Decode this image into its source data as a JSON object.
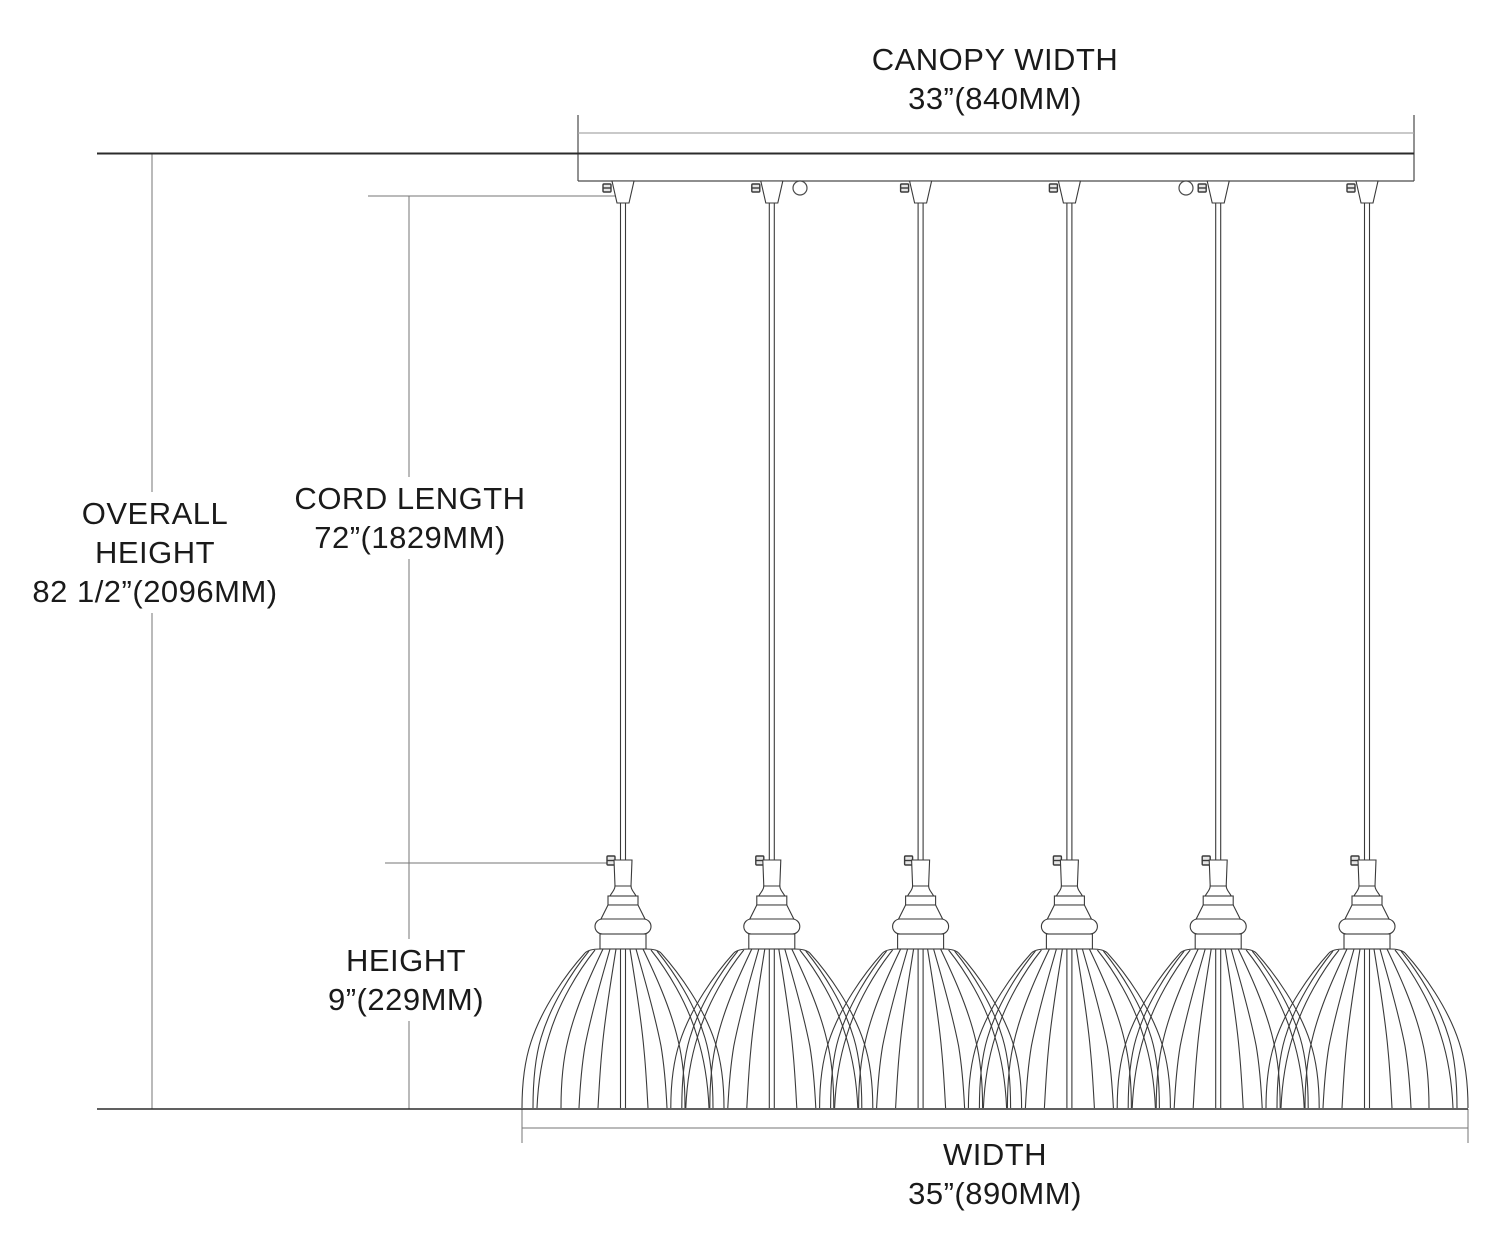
{
  "title": "Pendant fixture dimension drawing",
  "labels": {
    "canopy_width": {
      "line1": "CANOPY WIDTH",
      "line2": "33”(840MM)"
    },
    "overall_height": {
      "line1": "OVERALL",
      "line2": "HEIGHT",
      "line3": "82 1/2”(2096MM)"
    },
    "cord_length": {
      "line1": "CORD LENGTH",
      "line2": "72”(1829MM)"
    },
    "height": {
      "line1": "HEIGHT",
      "line2": "9”(229MM)"
    },
    "width": {
      "line1": "WIDTH",
      "line2": "35”(890MM)"
    }
  },
  "dimensions": {
    "canopy_width": {
      "inches": "33\"",
      "mm": "840MM"
    },
    "overall_height": {
      "inches": "82 1/2\"",
      "mm": "2096MM"
    },
    "cord_length": {
      "inches": "72\"",
      "mm": "1829MM"
    },
    "height": {
      "inches": "9\"",
      "mm": "229MM"
    },
    "width": {
      "inches": "35\"",
      "mm": "890MM"
    }
  },
  "fixture": {
    "pendant_count": 6,
    "pendant_xs": [
      623,
      771.8,
      920.6,
      1069.4,
      1218.2,
      1367
    ],
    "canopy_hole_xs": [
      800,
      1186
    ],
    "canopy_hole_y": 188,
    "canopy_hole_r": 7
  },
  "colors": {
    "background": "#ffffff",
    "dimension_line": "#757575",
    "fixture_line": "#3a3a3a",
    "ceiling_line": "#2b2b2b",
    "canopy_inner_line": "#a9a9a9",
    "text": "#1a1a1a"
  }
}
